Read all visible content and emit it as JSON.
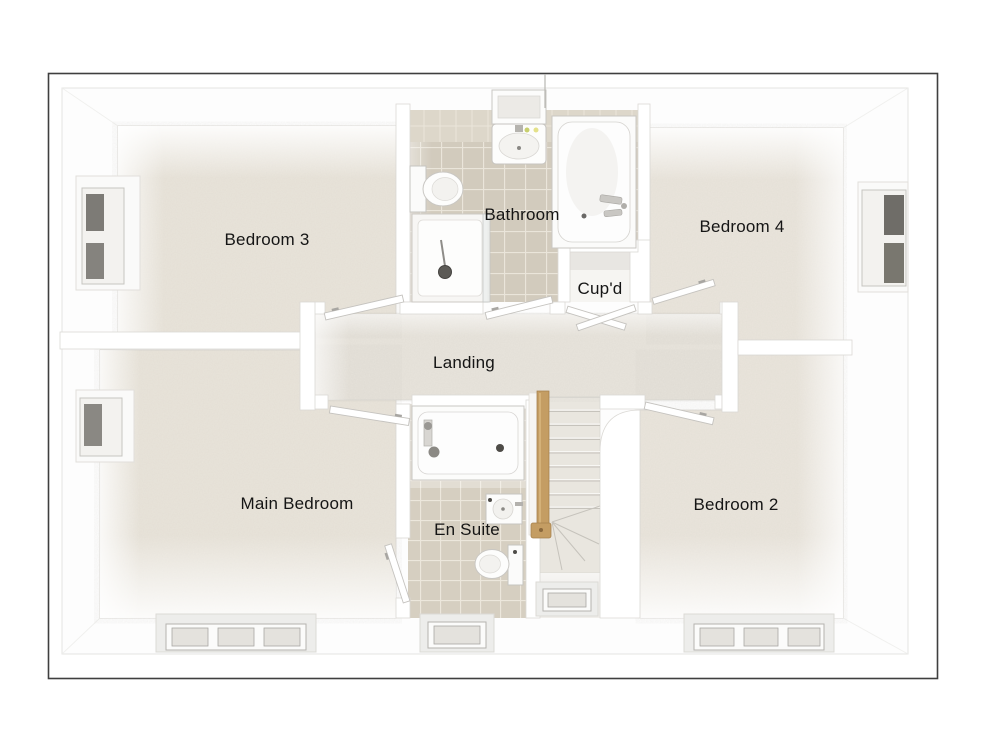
{
  "floorplan": {
    "style": "3d-top-down-dollhouse-view",
    "floor": "First Floor",
    "rooms": [
      {
        "id": "bedroom-3",
        "label": "Bedroom 3"
      },
      {
        "id": "bathroom",
        "label": "Bathroom"
      },
      {
        "id": "bedroom-4",
        "label": "Bedroom 4"
      },
      {
        "id": "cupboard",
        "label": "Cup'd"
      },
      {
        "id": "landing",
        "label": "Landing"
      },
      {
        "id": "main-bedroom",
        "label": "Main Bedroom"
      },
      {
        "id": "en-suite",
        "label": "En Suite"
      },
      {
        "id": "bedroom-2",
        "label": "Bedroom 2"
      }
    ],
    "fixtures": [
      "bathtub",
      "shower-enclosure",
      "shower-head",
      "toilet",
      "wash-basin",
      "mirror-cabinet",
      "shower-bath",
      "staircase",
      "winder-steps",
      "wooden-handrail",
      "newel-post",
      "window",
      "door-leaf",
      "cupboard-double-doors"
    ],
    "colors": {
      "background": "#ffffff",
      "frame": "#3f3f3f",
      "wall": "#ffffff",
      "wall_edge": "#dbd9d5",
      "carpet": "#e9e4da",
      "landing_carpet": "#e8e4dc",
      "bathroom_tile": "#d2cbbd",
      "ensuite_tile": "#d6cfc1",
      "tile_grout": "#eae5da",
      "stair_carpet": "#e9e6df",
      "handrail_wood": "#c49d63",
      "window_glass_dark": "#7d7b76",
      "window_glass_light": "#e4e2dd",
      "label_text": "#151515"
    }
  }
}
